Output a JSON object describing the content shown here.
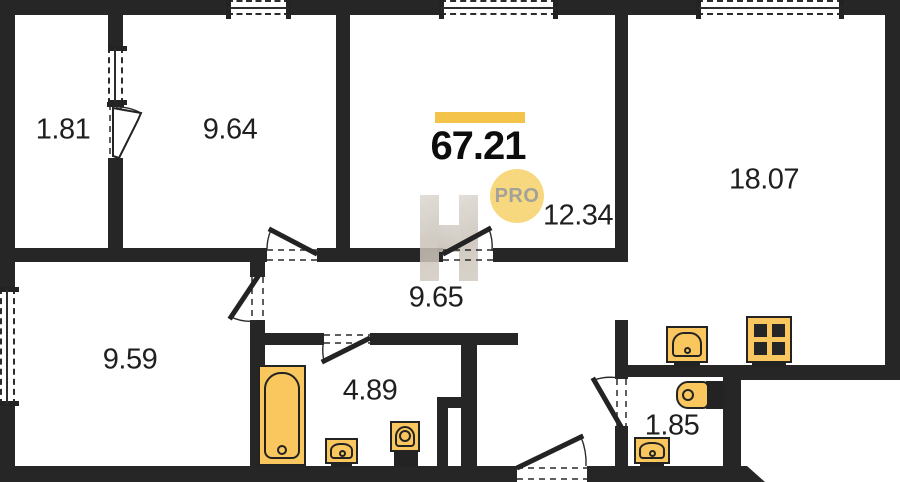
{
  "total": {
    "area_value": "67.21",
    "badge_label": "PRO"
  },
  "areas": {
    "balcony": "1.81",
    "bedroom": "9.64",
    "living_room": "12.34",
    "kitchen_living_room": "18.07",
    "hallway": "9.65",
    "second_room": "9.59",
    "bathroom": "4.89",
    "wc": "1.85"
  },
  "colors": {
    "wall": "#262626",
    "fixture_fill": "#f9c75e",
    "fixture_outline": "#232323",
    "accent_bar": "#f4c349",
    "badge_bg": "#f8d87e",
    "badge_text": "#a2a29a",
    "watermark": "#cbc4ba",
    "label_text": "#1f1f1f",
    "floor": "#ffffff"
  }
}
